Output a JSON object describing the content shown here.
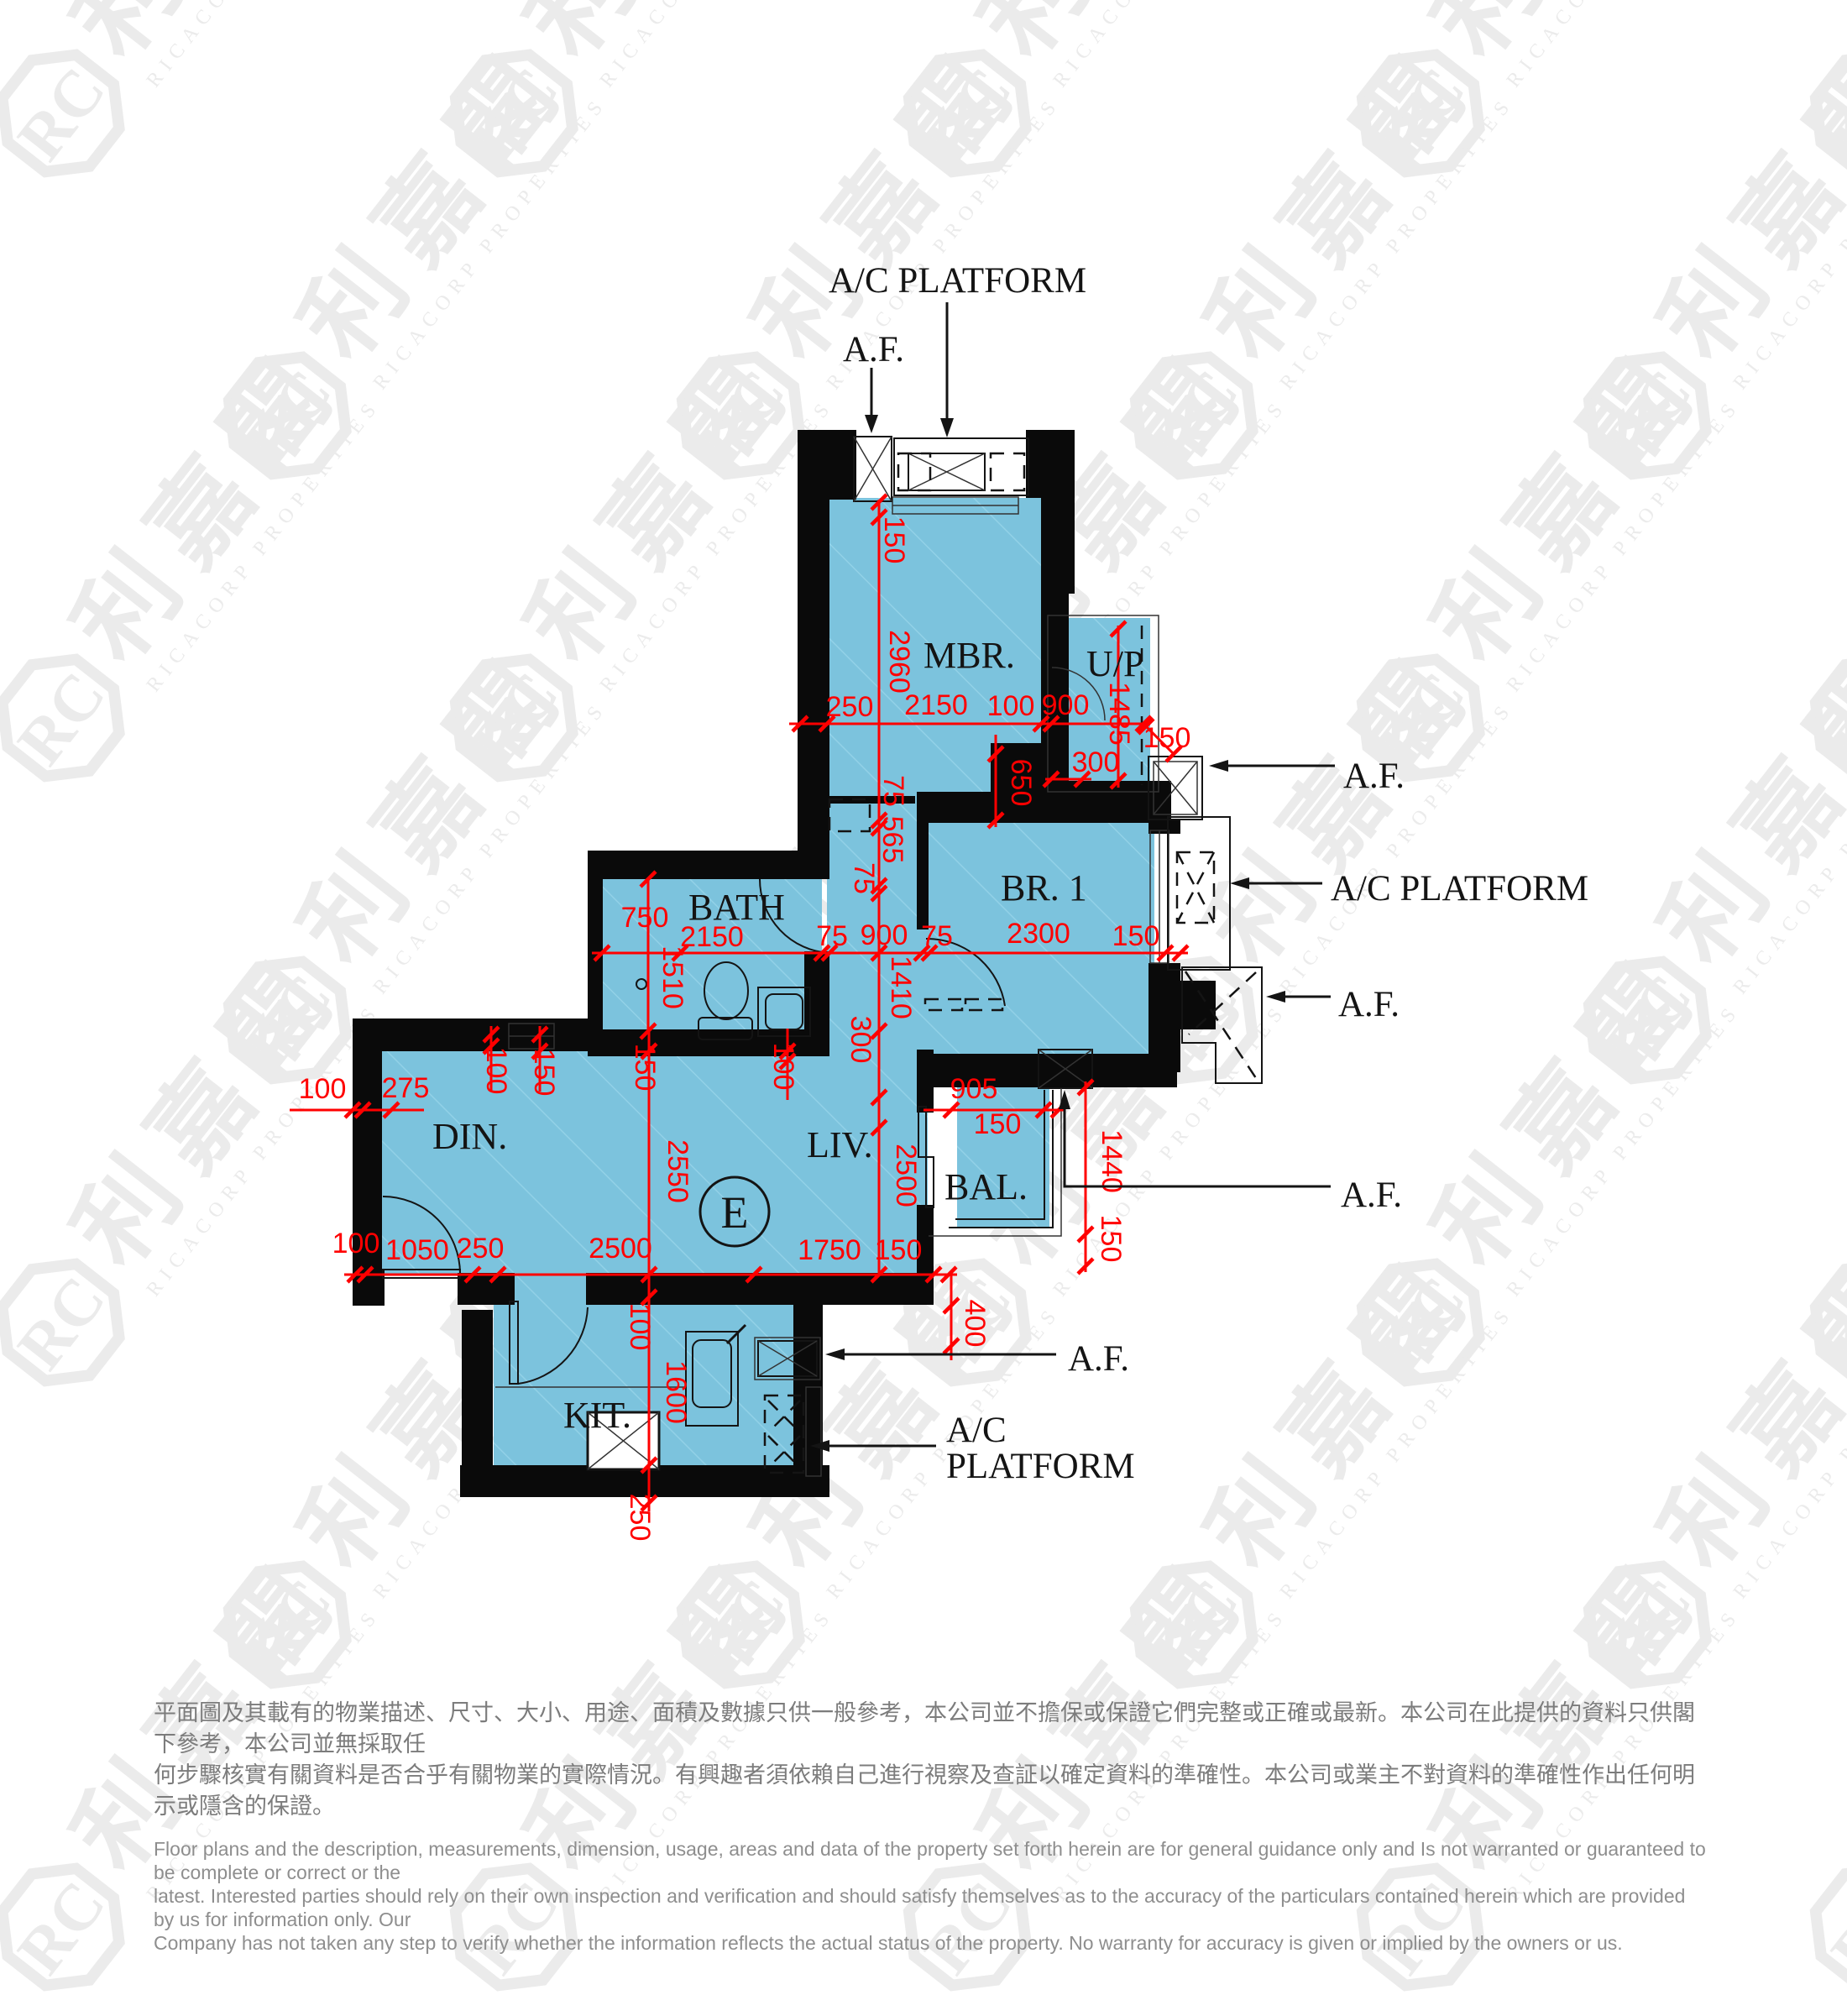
{
  "plan": {
    "unit": "E",
    "rooms": {
      "mbr": "MBR.",
      "up": "U/P",
      "br1": "BR. 1",
      "bath": "BATH",
      "din": "DIN.",
      "liv": "LIV.",
      "bal": "BAL.",
      "kit": "KIT."
    },
    "annotations": {
      "ac_platform": "A/C PLATFORM",
      "af": "A.F.",
      "ac": "A/C",
      "platform": "PLATFORM"
    },
    "dims": [
      "150",
      "2960",
      "250",
      "2150",
      "100",
      "900",
      "1485",
      "150",
      "650",
      "300",
      "75",
      "565",
      "75",
      "750",
      "2150",
      "75",
      "900",
      "75",
      "2300",
      "150",
      "1510",
      "1410",
      "300",
      "2500",
      "150",
      "2550",
      "100",
      "150",
      "100",
      "275",
      "100",
      "1050",
      "250",
      "2500",
      "1750",
      "150",
      "905",
      "150",
      "1440",
      "150",
      "400",
      "100",
      "1600",
      "250",
      "100"
    ]
  },
  "watermark": {
    "logo_text": "利嘉閣",
    "logo_sub": "RICACORP PROPERTIES",
    "monogram": "RC"
  },
  "disclaimer": {
    "zh1": "平面圖及其載有的物業描述、尺寸、大小、用途、面積及數據只供一般參考，本公司並不擔保或保證它們完整或正確或最新。本公司在此提供的資料只供閣下參考，本公司並無採取任",
    "zh2": "何步驟核實有關資料是否合乎有關物業的實際情況。有興趣者須依賴自己進行視察及查証以確定資料的準確性。本公司或業主不對資料的準確性作出任何明示或隱含的保證。",
    "en1": "Floor plans and the description, measurements, dimension, usage, areas and data of the property set forth herein are for general guidance only and Is not warranted or guaranteed to be complete or correct or the",
    "en2": "latest. Interested parties should rely on their own inspection and verification and should satisfy themselves as to the accuracy of the particulars contained herein which are provided by us for information only.  Our",
    "en3": "Company has not taken any step to verify whether the information reflects the actual status of the property.  No warranty for accuracy is given or implied by the owners or us."
  }
}
